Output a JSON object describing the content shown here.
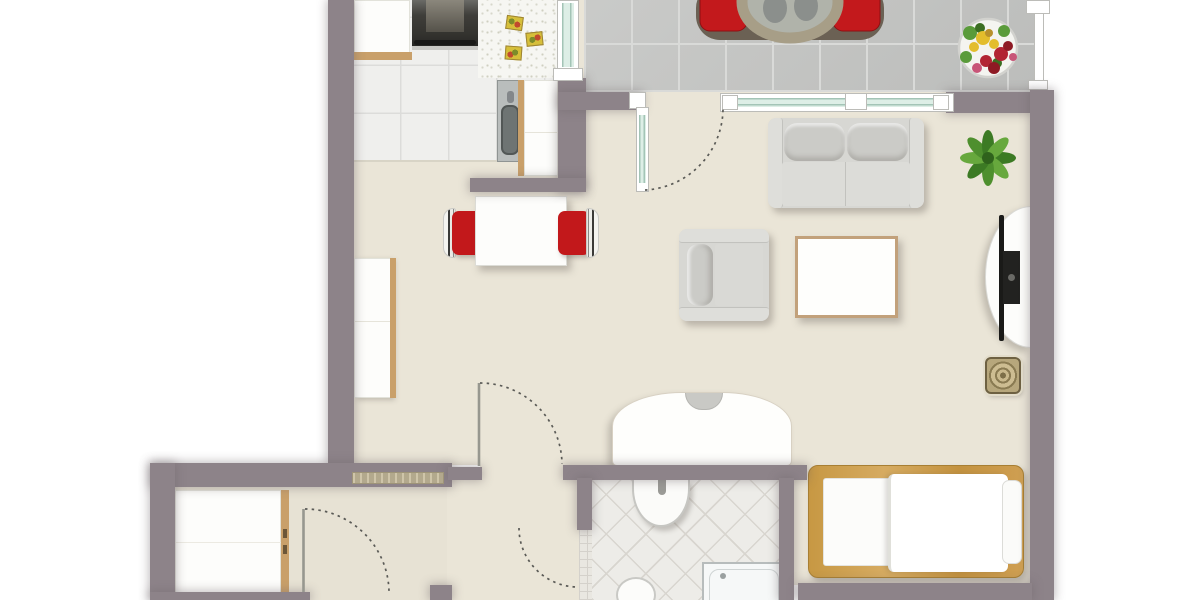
{
  "meta": {
    "type": "floor-plan",
    "view": "top-down 2D apartment plan",
    "text_labels": "none visible in image"
  },
  "colors": {
    "outside": "#ffffff",
    "wall": "#8d8389",
    "floor": "#eae5d7",
    "floor-hall": "#e7e2d4",
    "kitchen-tile": "#efefed",
    "kitchen-grout": "#dcdcda",
    "terrace-tile": "#c6c7c5",
    "terrace-grout": "#d9dad8",
    "bath-tile": "#edece8",
    "bath-grout": "#d8d5cf",
    "glass": "#ddeee6",
    "glass-line": "#a3c4b6",
    "frame-white": "#ffffff",
    "furniture-gray": "#d7d7d3",
    "furniture-gray-dark": "#cbcbc7",
    "accent-red": "#c2181b",
    "wood": "#c9a06a",
    "bed-wood": "#c6973f",
    "plant-green": "#4e8f2e",
    "table-white": "#fdfdfb",
    "tv-black": "#1a1a18",
    "door-arc": "#5a5a56"
  },
  "plan": {
    "rooms": [
      {
        "id": "kitchen",
        "features": [
          "stove",
          "counter-top-left",
          "speckled-counter",
          "sink",
          "cutting-boards",
          "white-floor-tiles",
          "window-to-terrace"
        ]
      },
      {
        "id": "terrace",
        "features": [
          "round-table",
          "red-chair-left",
          "red-chair-right",
          "flower-pot",
          "railing",
          "concrete-tiles"
        ]
      },
      {
        "id": "living-dining",
        "features": [
          "dining-table",
          "red-dining-chair-left",
          "red-dining-chair-right",
          "sofa",
          "armchair",
          "coffee-table",
          "tv-stand",
          "tv",
          "potted-plant",
          "round-side-stool",
          "curved-sideboard",
          "tall-cabinet"
        ]
      },
      {
        "id": "sleeping-area",
        "features": [
          "single-bed",
          "mattress",
          "duvet",
          "pillow"
        ]
      },
      {
        "id": "bathroom",
        "features": [
          "washbasin",
          "faucet",
          "toilet",
          "shower-tray",
          "diagonal-floor-tiles"
        ]
      },
      {
        "id": "hallway",
        "features": [
          "wardrobe",
          "radiator-grille",
          "entry-door"
        ]
      }
    ],
    "doors": [
      "terrace-glass-door",
      "living-room-door",
      "hallway-door",
      "bathroom-door"
    ],
    "windows": [
      "kitchen-window",
      "living-room-window"
    ]
  }
}
